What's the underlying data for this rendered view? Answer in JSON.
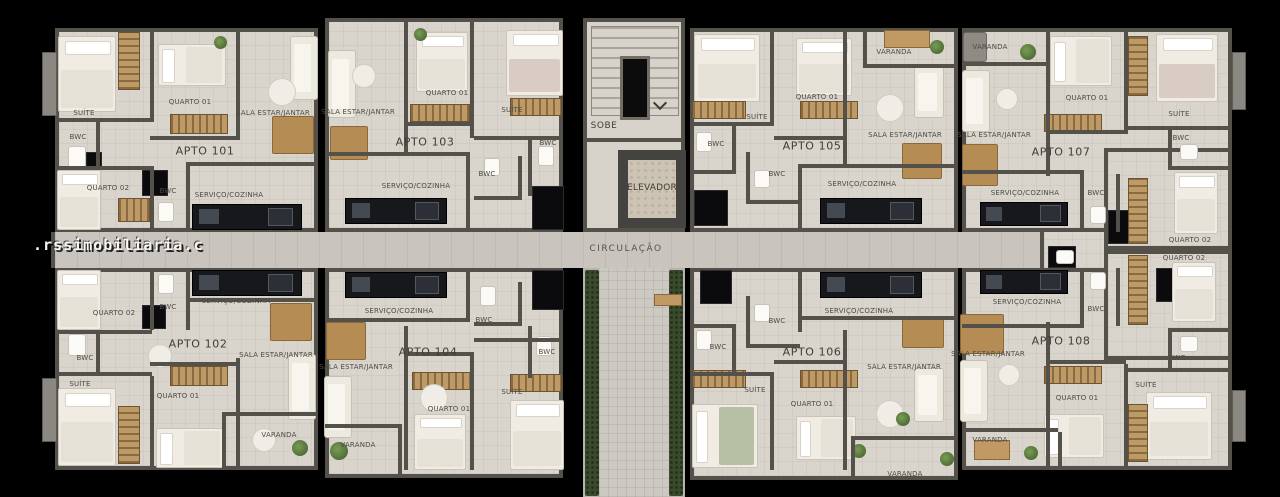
{
  "watermark": ".rssimobiliaria.c",
  "core": {
    "stairs_label": "SOBE",
    "elevator_label": "ELEVADOR",
    "corridor_label": "CIRCULAÇÃO"
  },
  "apartments": [
    {
      "name": "APTO 101",
      "nx": 205,
      "ny": 151,
      "rect": [
        55,
        28,
        263,
        204
      ],
      "rooms": [
        {
          "label": "SUÍTE",
          "x": 84,
          "y": 113
        },
        {
          "label": "QUARTO 01",
          "x": 190,
          "y": 102
        },
        {
          "label": "SALA ESTAR/JANTAR",
          "x": 273,
          "y": 113
        },
        {
          "label": "BWC",
          "x": 78,
          "y": 137
        },
        {
          "label": "QUARTO 02",
          "x": 108,
          "y": 188
        },
        {
          "label": "BWC",
          "x": 168,
          "y": 191
        },
        {
          "label": "SERVIÇO/COZINHA",
          "x": 229,
          "y": 195
        }
      ]
    },
    {
      "name": "APTO 103",
      "nx": 425,
      "ny": 142,
      "rect": [
        325,
        18,
        238,
        214
      ],
      "rooms": [
        {
          "label": "SALA ESTAR/JANTAR",
          "x": 358,
          "y": 112
        },
        {
          "label": "QUARTO 01",
          "x": 447,
          "y": 93
        },
        {
          "label": "SUÍTE",
          "x": 512,
          "y": 110
        },
        {
          "label": "BWC",
          "x": 548,
          "y": 143
        },
        {
          "label": "BWC",
          "x": 487,
          "y": 174
        },
        {
          "label": "SERVIÇO/COZINHA",
          "x": 416,
          "y": 186
        }
      ]
    },
    {
      "name": "APTO 105",
      "nx": 812,
      "ny": 146,
      "rect": [
        690,
        28,
        268,
        204
      ],
      "rooms": [
        {
          "label": "SUÍTE",
          "x": 757,
          "y": 117
        },
        {
          "label": "QUARTO 01",
          "x": 817,
          "y": 97
        },
        {
          "label": "VARANDA",
          "x": 894,
          "y": 52
        },
        {
          "label": "SALA ESTAR/JANTAR",
          "x": 905,
          "y": 135
        },
        {
          "label": "BWC",
          "x": 716,
          "y": 144
        },
        {
          "label": "BWC",
          "x": 777,
          "y": 174
        },
        {
          "label": "SERVIÇO/COZINHA",
          "x": 862,
          "y": 184
        }
      ]
    },
    {
      "name": "APTO 107",
      "nx": 1061,
      "ny": 152,
      "rect": [
        962,
        28,
        270,
        204
      ],
      "rooms": [
        {
          "label": "VARANDA",
          "x": 990,
          "y": 47
        },
        {
          "label": "QUARTO 01",
          "x": 1087,
          "y": 98
        },
        {
          "label": "SUÍTE",
          "x": 1179,
          "y": 114
        },
        {
          "label": "SALA ESTAR/JANTAR",
          "x": 994,
          "y": 135
        },
        {
          "label": "BWC",
          "x": 1181,
          "y": 138
        },
        {
          "label": "SERVIÇO/COZINHA",
          "x": 1025,
          "y": 193
        },
        {
          "label": "BWC",
          "x": 1096,
          "y": 193
        },
        {
          "label": "QUARTO 02",
          "x": 1190,
          "y": 240
        }
      ]
    },
    {
      "name": "APTO 102",
      "nx": 198,
      "ny": 344,
      "rect": [
        55,
        268,
        263,
        202
      ],
      "rooms": [
        {
          "label": "QUARTO 02",
          "x": 114,
          "y": 313
        },
        {
          "label": "BWC",
          "x": 168,
          "y": 307
        },
        {
          "label": "SERVIÇO/COZINHA",
          "x": 236,
          "y": 301
        },
        {
          "label": "SALA ESTAR/JANTAR",
          "x": 276,
          "y": 355
        },
        {
          "label": "BWC",
          "x": 85,
          "y": 358
        },
        {
          "label": "SUÍTE",
          "x": 80,
          "y": 384
        },
        {
          "label": "QUARTO 01",
          "x": 178,
          "y": 396
        },
        {
          "label": "VARANDA",
          "x": 279,
          "y": 435
        }
      ]
    },
    {
      "name": "APTO 104",
      "nx": 428,
      "ny": 352,
      "rect": [
        325,
        268,
        238,
        210
      ],
      "rooms": [
        {
          "label": "SERVIÇO/COZINHA",
          "x": 399,
          "y": 311
        },
        {
          "label": "BWC",
          "x": 484,
          "y": 320
        },
        {
          "label": "BWC",
          "x": 547,
          "y": 352
        },
        {
          "label": "SALA ESTAR/JANTAR",
          "x": 356,
          "y": 367
        },
        {
          "label": "QUARTO 01",
          "x": 449,
          "y": 409
        },
        {
          "label": "SUÍTE",
          "x": 512,
          "y": 392
        },
        {
          "label": "VARANDA",
          "x": 358,
          "y": 445
        }
      ]
    },
    {
      "name": "APTO 106",
      "nx": 812,
      "ny": 352,
      "rect": [
        690,
        268,
        268,
        212
      ],
      "rooms": [
        {
          "label": "BWC",
          "x": 777,
          "y": 321
        },
        {
          "label": "SERVIÇO/COZINHA",
          "x": 859,
          "y": 311
        },
        {
          "label": "BWC",
          "x": 718,
          "y": 347
        },
        {
          "label": "SALA ESTAR/JANTAR",
          "x": 904,
          "y": 367
        },
        {
          "label": "SUÍTE",
          "x": 755,
          "y": 390
        },
        {
          "label": "QUARTO 01",
          "x": 812,
          "y": 404
        },
        {
          "label": "VARANDA",
          "x": 905,
          "y": 474
        }
      ]
    },
    {
      "name": "APTO 108",
      "nx": 1061,
      "ny": 341,
      "rect": [
        962,
        268,
        270,
        202
      ],
      "rooms": [
        {
          "label": "QUARTO 02",
          "x": 1184,
          "y": 258
        },
        {
          "label": "SERVIÇO/COZINHA",
          "x": 1027,
          "y": 302
        },
        {
          "label": "BWC",
          "x": 1096,
          "y": 309
        },
        {
          "label": "SALA ESTAR/JANTAR",
          "x": 988,
          "y": 354
        },
        {
          "label": "BWC",
          "x": 1177,
          "y": 358
        },
        {
          "label": "SUÍTE",
          "x": 1146,
          "y": 385
        },
        {
          "label": "QUARTO 01",
          "x": 1077,
          "y": 398
        },
        {
          "label": "VARANDA",
          "x": 990,
          "y": 440
        }
      ]
    }
  ]
}
